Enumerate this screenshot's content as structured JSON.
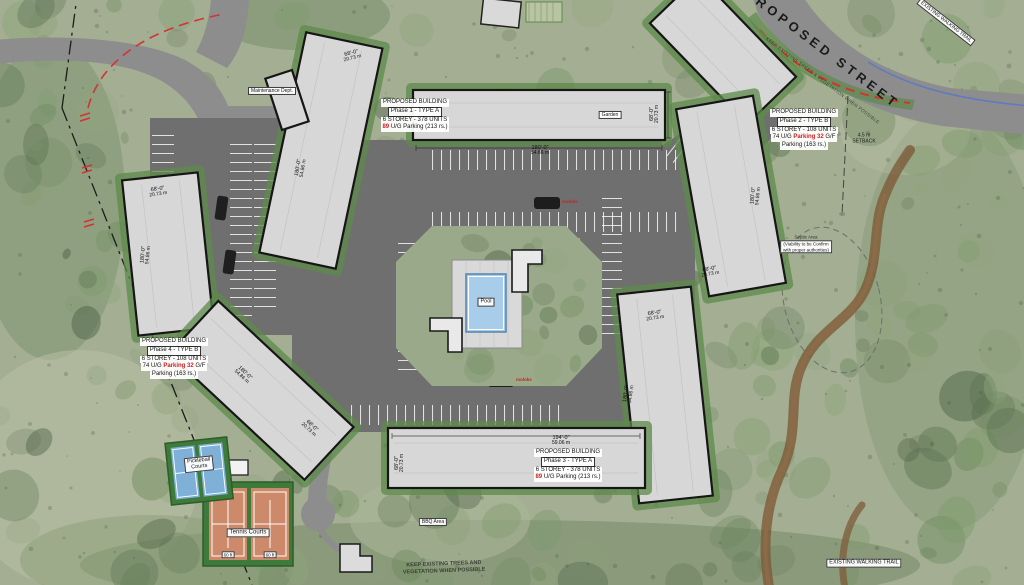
{
  "colors": {
    "accent": "#cc2222",
    "road": "#8d8d8d",
    "asphalt": "#6f6f6f",
    "building": "#d7d7d7",
    "green-edge": "#5d8a4a",
    "pool-water": "#a8cdea",
    "tennis-court": "#cd8a6a",
    "pickleball-court": "#7fb0d8",
    "trail-brown": "#7d5b39"
  },
  "labels": {
    "street": "PROPOSED STREET",
    "maintenance": "Maintenance Dept.",
    "garden": "Garden",
    "pool": "Pool",
    "bbq": "BBQ Area",
    "tennis": "Tennis Courts",
    "pickleball_1": "Pickleball",
    "pickleball_2": "Courts",
    "court_dim": "60 ft",
    "moloks": "moloks",
    "walking_trail": "EXISTING WALKING TRAIL",
    "keep_trees_1": "KEEP EXISTING TREES AND",
    "keep_trees_2": "VEGETATION WHEN POSSIBLE",
    "street_edge_note": "KEEP EXISTING TREES & VEGETATION WHEN POSSIBLE",
    "septic_1": "Septic Area",
    "septic_2": "(Viability to be Confirm",
    "septic_3": "with proper authorities)",
    "setback_1": "4.5 m",
    "setback_2": "SETBACK"
  },
  "buildings": {
    "phase1": {
      "l1": "PROPOSED BUILDING",
      "l2": "Phase 1 - TYPE A",
      "l3": "6 STOREY - 378 UNITS",
      "p_num": "89",
      "p_rest": " U/G Parking (213 rs.)"
    },
    "phase2": {
      "l1": "PROPOSED BUILDING",
      "l2": "Phase 2 - TYPE B",
      "l3": "6 STOREY - 108 UNITS",
      "p_a": "74 U/G ",
      "p_b": "Parking 32",
      "p_c": " G/F",
      "p_last": "Parking (163 rs.)"
    },
    "phase3": {
      "l1": "PROPOSED BUILDING",
      "l2": "Phase 3 - TYPE A",
      "l3": "6 STOREY - 378 UNITS",
      "p_num": "89",
      "p_rest": " U/G Parking (213 rs.)"
    },
    "phase4": {
      "l1": "PROPOSED BUILDING",
      "l2": "Phase 4 - TYPE B",
      "l3": "6 STOREY - 108 UNITS",
      "p_a": "74 U/G ",
      "p_b": "Parking 32",
      "p_c": " G/F",
      "p_last": "Parking (163 rs.)"
    }
  },
  "dims": {
    "len180": {
      "ft": "180'-0\"",
      "m": "54.86 m"
    },
    "wid68": {
      "ft": "68'-0\"",
      "m": "20.73 m"
    },
    "len194": {
      "ft": "194'-0\"",
      "m": "59.06 m"
    }
  }
}
